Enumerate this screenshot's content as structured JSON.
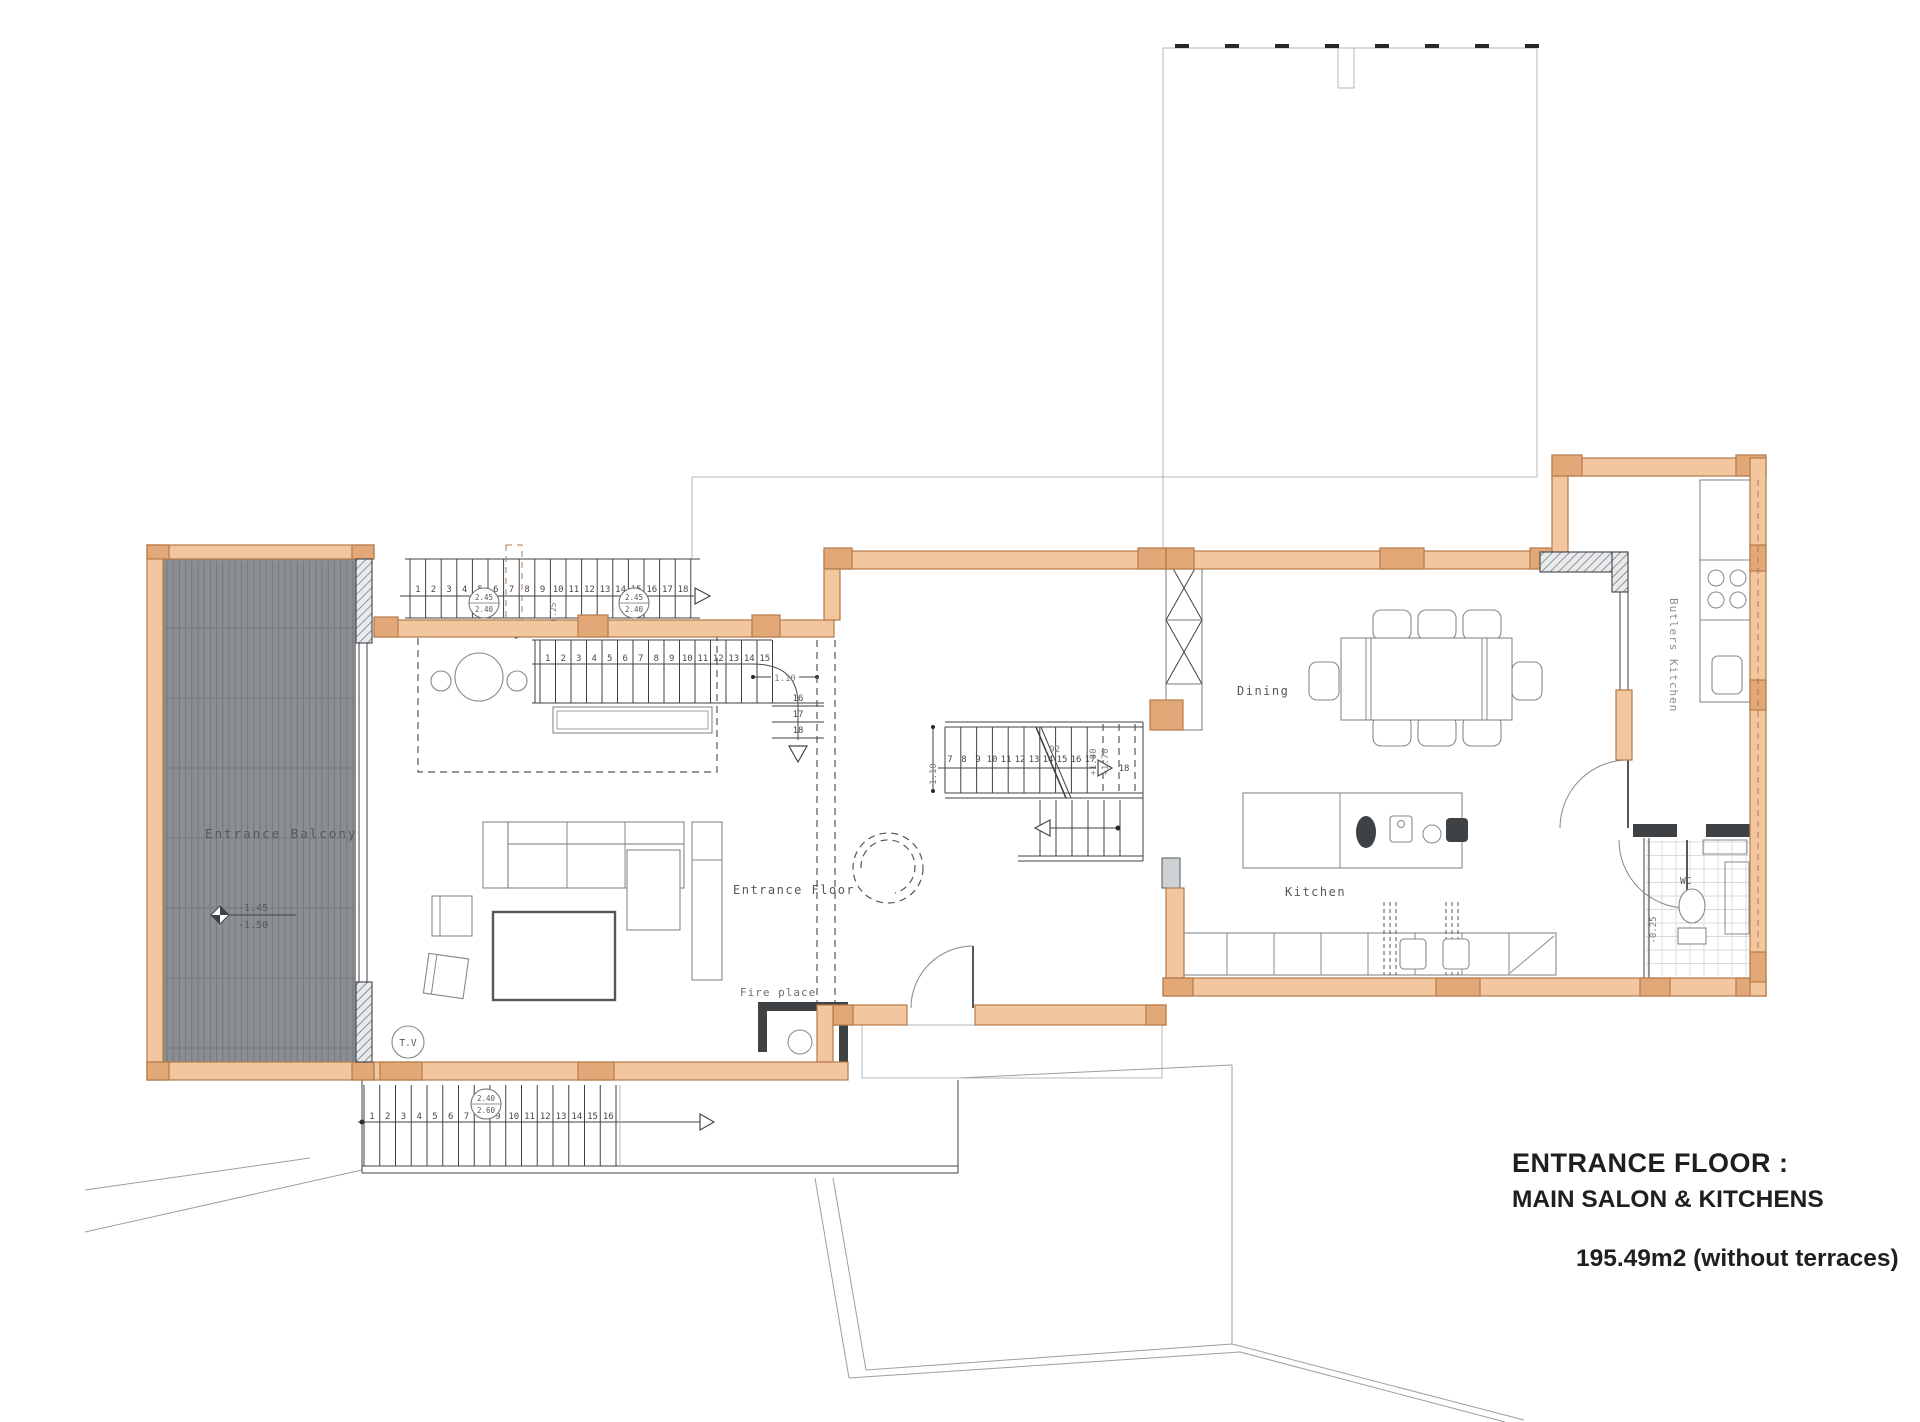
{
  "title_block": {
    "line1": "ENTRANCE FLOOR :",
    "line2": "MAIN SALON & KITCHENS",
    "area": "195.49m2 (without terraces)"
  },
  "room_labels": {
    "entrance_balcony": "Entrance Balcony",
    "entrance_floor": "Entrance Floor",
    "fire_place": "Fire place",
    "dining": "Dining",
    "kitchen": "Kitchen",
    "butlers_kitchen": "Butlers Kitchen",
    "wc": "WC",
    "tv": "T.V"
  },
  "annotations": {
    "balcony_level_top": "-1.45",
    "balcony_level_bottom": "-1.50",
    "upper_stair_marker_top": "2.45",
    "upper_stair_marker_bottom": "2.40",
    "upper_stair_marker2_top": "2.45",
    "upper_stair_marker2_bottom": "2.40",
    "upper_stair_step_note": "0.25",
    "salon_stair_width": "1.10",
    "center_stair_width": "1.10",
    "center_stair_note": ".92",
    "landing_level_a": "+1.80",
    "landing_level_b": "+1.70",
    "lower_stair_marker_top": "2.40",
    "lower_stair_marker_bottom": "2.60",
    "wc_level": "-0.25",
    "center_stair_last_tread": "18"
  },
  "stairs": {
    "top_run_treads": [
      "1",
      "2",
      "3",
      "4",
      "5",
      "6",
      "7",
      "8",
      "9",
      "10",
      "11",
      "12",
      "13",
      "14",
      "15",
      "16",
      "17",
      "18"
    ],
    "salon_run_treads": [
      "1",
      "2",
      "3",
      "4",
      "5",
      "6",
      "7",
      "8",
      "9",
      "10",
      "11",
      "12",
      "13",
      "14",
      "15"
    ],
    "salon_run_turn": [
      "16",
      "17",
      "18"
    ],
    "center_run_treads": [
      "7",
      "8",
      "9",
      "10",
      "11",
      "12",
      "13",
      "14",
      "15",
      "16",
      "17"
    ],
    "lower_run_treads": [
      "1",
      "2",
      "3",
      "4",
      "5",
      "6",
      "7",
      "8",
      "9",
      "10",
      "11",
      "12",
      "13",
      "14",
      "15",
      "16"
    ]
  },
  "colors": {
    "wall_fill": "#f2c69e",
    "wall_stroke": "#b57a49",
    "post_fill": "#e2a878",
    "deck_fill": "#8b8e92",
    "deck_line": "#75787c",
    "ink": "#3f4245",
    "label": "#55585b",
    "title": "#1f1f1f"
  }
}
